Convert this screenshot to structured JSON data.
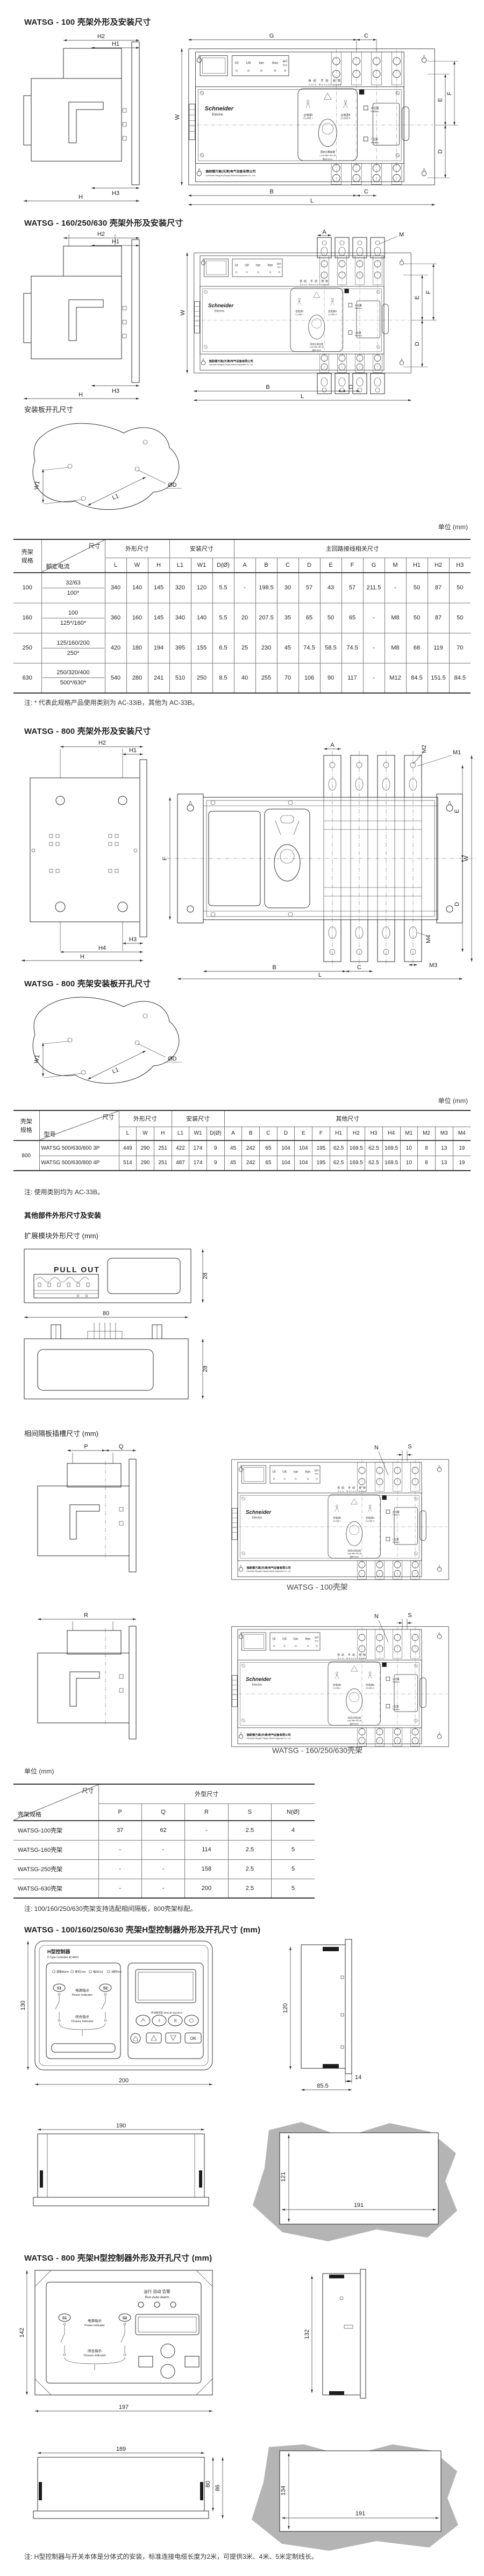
{
  "unit_label": "单位 (mm)",
  "headings": {
    "s1": "WATSG - 100 壳架外形及安装尺寸",
    "s2": "WATSG - 160/250/630 壳架外形及安装尺寸",
    "s3": "安装板开孔尺寸",
    "s4": "WATSG - 800 壳架外形及安装尺寸",
    "s5": "WATSG - 800 壳架安装板开孔尺寸",
    "s6": "其他部件外形尺寸及安装",
    "s6a": "扩展模块外形尺寸 (mm)",
    "s6b": "相间隔板插槽尺寸 (mm)",
    "s7": "WATSG - 100/160/250/630 壳架H型控制器外形及开孔尺寸 (mm)",
    "s8": "WATSG - 800 壳架H型控制器外形及开孔尺寸 (mm)"
  },
  "captions": {
    "frame100": "WATSG - 100壳架",
    "frame160": "WATSG - 160/250/630壳架"
  },
  "notes": {
    "n1": "注: * 代表此规格产品使用类别为 AC-33iB，其他为 AC-33B。",
    "n2": "注: 使用类别均为 AC-33B。",
    "n3": "注: 100/160/250/630壳架支持选配相间隔板，800壳架标配。",
    "n4": "注: H型控制器与开关本体是分体式的安装，标准连接电缆长度为2米，可提供3米、4米、5米定制线长。"
  },
  "face": {
    "meter": [
      "UI",
      "UII",
      "Ion",
      "IIon"
    ],
    "run_cn": "运行",
    "run_en": "Run",
    "modes_cn": "自动  手动  挂锁",
    "modes_en": "Auto  Manual  Lock",
    "brand": "Schneider",
    "brand_sub": "Electric",
    "close1_cn": "合电源I",
    "close1_en": "CLOSE I",
    "close2_cn": "合电源II",
    "close2_en": "CLOSE II",
    "pos2_cn": "II 位置",
    "pos2_en": "Position",
    "pos1_cn": "I 位置",
    "pos1_en": "Position",
    "lock_cn": "须双分再挂锁",
    "lock_en": "Lock after I&II off",
    "lock_dia": "锁Ø3.5mm",
    "company_cn": "施耐德万高(天津)电气设备有限公司",
    "company_en": "Schneider Wingoal (Tianjin) Electric Equipment Co., Ltd."
  },
  "dims": {
    "d1": {
      "h2": "H2",
      "h1": "H1",
      "h3": "H3",
      "h": "H",
      "w": "W",
      "g": "G",
      "c_top": "C",
      "e": "E",
      "f": "F",
      "d": "D",
      "b": "B",
      "c_bot": "C",
      "l": "L"
    },
    "d2": {
      "h2": "H2",
      "h1": "H1",
      "h3": "H3",
      "h": "H",
      "w": "W",
      "a": "A",
      "m": "M",
      "e": "E",
      "f": "F",
      "d": "D",
      "b": "B",
      "c": "C",
      "l": "L"
    },
    "plate": {
      "w1": "W1",
      "l1": "L1",
      "dd": "ØD"
    },
    "d4": {
      "h2": "H2",
      "h1": "H1",
      "h3": "H3",
      "h4": "H4",
      "h": "H",
      "a": "A",
      "m1": "M1",
      "m2": "M2",
      "m3": "M3",
      "m4": "M4",
      "f": "F",
      "e": "E",
      "w": "W",
      "d": "D",
      "b": "B",
      "c": "C",
      "l": "L"
    },
    "pullout": {
      "label": "PULL OUT",
      "h_top": "28",
      "w": "80",
      "h_bot": "28"
    },
    "part": {
      "p": "P",
      "q": "Q",
      "r": "R",
      "n": "N",
      "s": "S"
    },
    "c1": {
      "h": "130",
      "w": "200",
      "side_h": "120",
      "side_w": "85.5",
      "side_t": "14",
      "bot_w": "190",
      "cut_h": "121",
      "cut_w": "191"
    },
    "c2": {
      "h": "142",
      "w": "197",
      "side_h": "132",
      "bot_w": "189",
      "bot_h1": "80",
      "bot_h2": "86",
      "cut_h": "134",
      "cut_w": "191"
    }
  },
  "table1": {
    "frame_l1": "壳架",
    "frame_l2": "规格",
    "corner_top": "尺寸",
    "corner_left": "额定电流",
    "groups": [
      "外形尺寸",
      "安装尺寸",
      "主回路接线相关尺寸"
    ],
    "cols": [
      "L",
      "W",
      "H",
      "L1",
      "W1",
      "D(Ø)",
      "A",
      "B",
      "C",
      "D",
      "E",
      "F",
      "G",
      "M",
      "H1",
      "H2",
      "H3"
    ],
    "rows": [
      {
        "frame": "100",
        "cur1": "32/63",
        "cur2": "100*",
        "v": [
          "340",
          "140",
          "145",
          "320",
          "120",
          "5.5",
          "-",
          "198.5",
          "30",
          "57",
          "43",
          "57",
          "211.5",
          "-",
          "50",
          "87",
          "50"
        ]
      },
      {
        "frame": "160",
        "cur1": "100",
        "cur2": "125*/160*",
        "v": [
          "360",
          "160",
          "145",
          "340",
          "140",
          "5.5",
          "20",
          "207.5",
          "35",
          "65",
          "50",
          "65",
          "-",
          "M8",
          "50",
          "87",
          "50"
        ]
      },
      {
        "frame": "250",
        "cur1": "125/160/200",
        "cur2": "250*",
        "v": [
          "420",
          "180",
          "194",
          "395",
          "155",
          "6.5",
          "25",
          "230",
          "45",
          "74.5",
          "58.5",
          "74.5",
          "-",
          "M8",
          "68",
          "119",
          "70"
        ]
      },
      {
        "frame": "630",
        "cur1": "250/320/400",
        "cur2": "500*/630*",
        "v": [
          "540",
          "280",
          "241",
          "510",
          "250",
          "8.5",
          "40",
          "255",
          "70",
          "106",
          "90",
          "117",
          "-",
          "M12",
          "84.5",
          "151.5",
          "84.5"
        ]
      }
    ]
  },
  "table2": {
    "frame_l1": "壳架",
    "frame_l2": "规格",
    "corner_top": "尺寸",
    "corner_left": "型号",
    "groups": [
      "外形尺寸",
      "安装尺寸",
      "其他尺寸"
    ],
    "cols": [
      "L",
      "W",
      "H",
      "L1",
      "W1",
      "D(Ø)",
      "A",
      "B",
      "C",
      "D",
      "E",
      "F",
      "H1",
      "H2",
      "H3",
      "H4",
      "M1",
      "M2",
      "M3",
      "M4"
    ],
    "frame": "800",
    "rows": [
      {
        "model": "WATSG 500/630/800 3P",
        "v": [
          "449",
          "290",
          "251",
          "422",
          "174",
          "9",
          "45",
          "242",
          "65",
          "104",
          "104",
          "195",
          "62.5",
          "169.5",
          "62.5",
          "169.5",
          "10",
          "8",
          "13",
          "19"
        ]
      },
      {
        "model": "WATSG 500/630/800 4P",
        "v": [
          "514",
          "290",
          "251",
          "487",
          "174",
          "9",
          "45",
          "242",
          "65",
          "104",
          "104",
          "195",
          "62.5",
          "169.5",
          "62.5",
          "169.5",
          "10",
          "8",
          "13",
          "19"
        ]
      }
    ]
  },
  "table3": {
    "corner_top": "尺寸",
    "corner_left": "壳架规格",
    "group": "外型尺寸",
    "cols": [
      "P",
      "Q",
      "R",
      "S",
      "N(Ø)"
    ],
    "rows": [
      {
        "name": "WATSG-100壳架",
        "v": [
          "37",
          "62",
          "-",
          "2.5",
          "4"
        ]
      },
      {
        "name": "WATSG-160壳架",
        "v": [
          "-",
          "-",
          "114",
          "2.5",
          "5"
        ]
      },
      {
        "name": "WATSG-250壳架",
        "v": [
          "-",
          "-",
          "158",
          "2.5",
          "5"
        ]
      },
      {
        "name": "WATSG-630壳架",
        "v": [
          "-",
          "-",
          "200",
          "2.5",
          "5"
        ]
      }
    ]
  },
  "hctrl": {
    "title_cn": "H型控制器",
    "title_en": "H Type Controller AC400V",
    "led1": "报警Alarm",
    "led2": "通讯Com",
    "led3": "输出Out",
    "led4": "消防Fire",
    "s1": "S1",
    "s2": "S2",
    "power_cn": "电源指示",
    "power_en": "Power Indicator",
    "closure_cn": "闭合指示",
    "closure_en": "Closure Indicator",
    "zone": "手动操作区 Manual operation",
    "b1": "I",
    "b2": "II",
    "ok": "OK"
  },
  "hctrl800": {
    "led_cn": "运行   自动   告警",
    "led_en": "Run  Auto  Alarm",
    "s1": "S1",
    "s2": "S2",
    "power_cn": "电源指示",
    "power_en": "Power indicator",
    "closure_cn": "闭合指示",
    "closure_en": "Closure indicator"
  }
}
